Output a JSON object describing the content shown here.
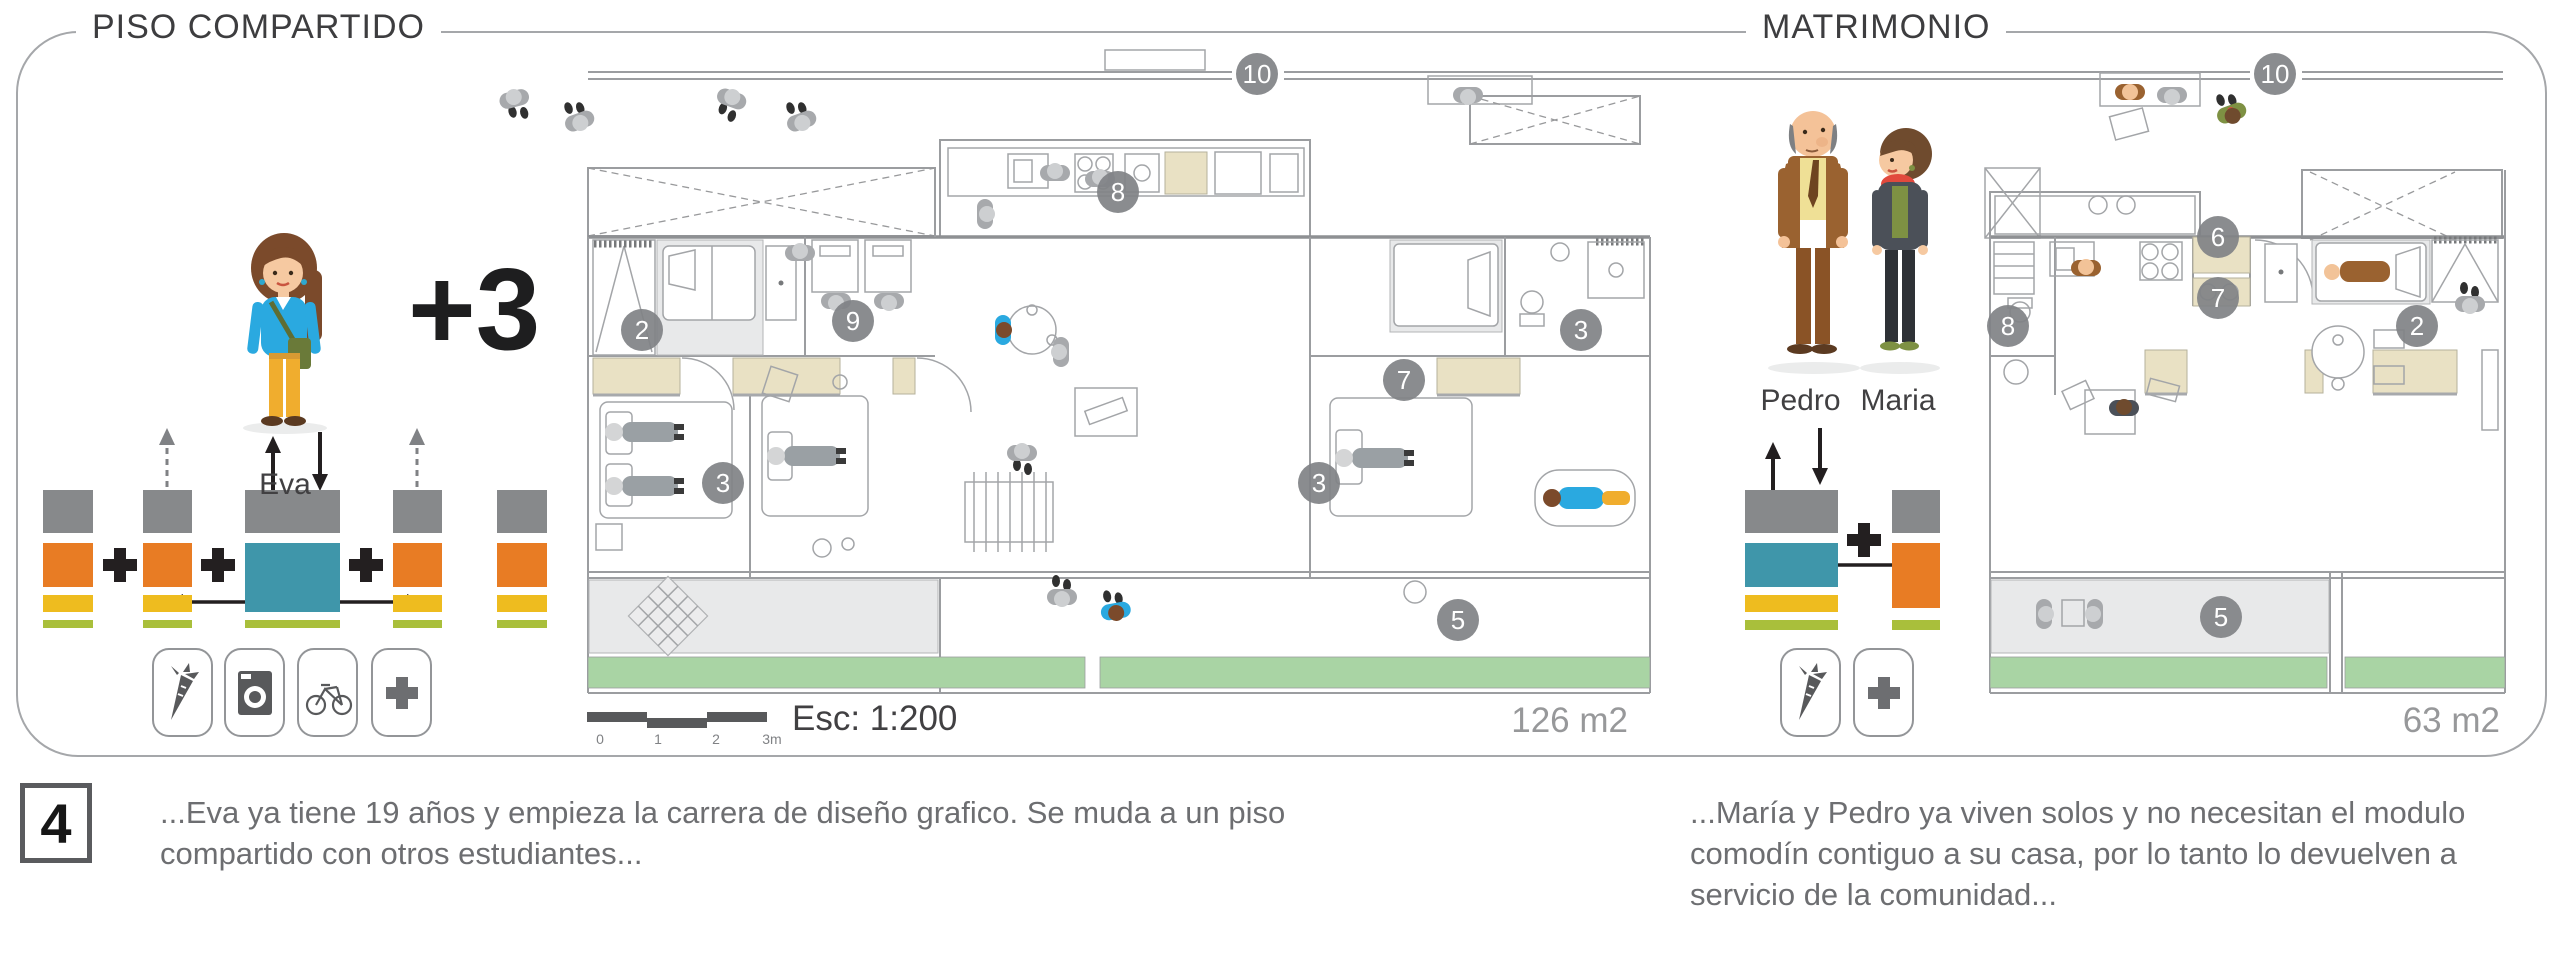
{
  "header": {
    "title_left": "PISO COMPARTIDO",
    "title_right": "MATRIMONIO"
  },
  "scenario_left": {
    "character_name": "Eva",
    "extra_occupants": "+3",
    "area_label": "126 m2",
    "icons": [
      "carrot-icon",
      "washing-machine-icon",
      "bicycle-icon",
      "plus-icon"
    ]
  },
  "scenario_right": {
    "character_names": [
      "Pedro",
      "Maria"
    ],
    "area_label": "63 m2",
    "icons": [
      "carrot-icon",
      "plus-icon"
    ]
  },
  "scale": {
    "label": "Esc: 1:200",
    "ticks": [
      {
        "t": "0",
        "x": 600
      },
      {
        "t": "1",
        "x": 658
      },
      {
        "t": "2",
        "x": 716
      },
      {
        "t": "3m",
        "x": 772
      }
    ]
  },
  "palette": {
    "gray": "#87898b",
    "orange": "#e87c24",
    "yellow": "#eebc1f",
    "teal": "#3f96aa",
    "olive": "#a9bf3b",
    "garden": "#a9d4a4",
    "beige": "#e9e1c4"
  },
  "module_blocks": [
    {
      "x": 43,
      "y": 490,
      "w": 50,
      "h": 43,
      "color": "#87898b"
    },
    {
      "x": 43,
      "y": 543,
      "w": 50,
      "h": 44,
      "color": "#e87c24"
    },
    {
      "x": 43,
      "y": 595,
      "w": 50,
      "h": 17,
      "color": "#eebc1f"
    },
    {
      "x": 43,
      "y": 620,
      "w": 50,
      "h": 8,
      "color": "#a9bf3b"
    },
    {
      "x": 143,
      "y": 490,
      "w": 49,
      "h": 43,
      "color": "#87898b"
    },
    {
      "x": 143,
      "y": 543,
      "w": 49,
      "h": 44,
      "color": "#e87c24"
    },
    {
      "x": 143,
      "y": 595,
      "w": 49,
      "h": 17,
      "color": "#eebc1f"
    },
    {
      "x": 143,
      "y": 620,
      "w": 49,
      "h": 8,
      "color": "#a9bf3b"
    },
    {
      "x": 245,
      "y": 490,
      "w": 95,
      "h": 43,
      "color": "#87898b"
    },
    {
      "x": 245,
      "y": 543,
      "w": 95,
      "h": 69,
      "color": "#3f96aa"
    },
    {
      "x": 245,
      "y": 620,
      "w": 95,
      "h": 8,
      "color": "#a9bf3b"
    },
    {
      "x": 393,
      "y": 490,
      "w": 49,
      "h": 43,
      "color": "#87898b"
    },
    {
      "x": 393,
      "y": 543,
      "w": 49,
      "h": 44,
      "color": "#e87c24"
    },
    {
      "x": 393,
      "y": 595,
      "w": 49,
      "h": 17,
      "color": "#eebc1f"
    },
    {
      "x": 393,
      "y": 620,
      "w": 49,
      "h": 8,
      "color": "#a9bf3b"
    },
    {
      "x": 497,
      "y": 490,
      "w": 50,
      "h": 43,
      "color": "#87898b"
    },
    {
      "x": 497,
      "y": 543,
      "w": 50,
      "h": 44,
      "color": "#e87c24"
    },
    {
      "x": 497,
      "y": 595,
      "w": 50,
      "h": 17,
      "color": "#eebc1f"
    },
    {
      "x": 497,
      "y": 620,
      "w": 50,
      "h": 8,
      "color": "#a9bf3b"
    },
    {
      "x": 1745,
      "y": 490,
      "w": 93,
      "h": 43,
      "color": "#87898b"
    },
    {
      "x": 1745,
      "y": 543,
      "w": 93,
      "h": 44,
      "color": "#3f96aa"
    },
    {
      "x": 1745,
      "y": 595,
      "w": 93,
      "h": 17,
      "color": "#eebc1f"
    },
    {
      "x": 1745,
      "y": 620,
      "w": 93,
      "h": 10,
      "color": "#a9bf3b"
    },
    {
      "x": 1892,
      "y": 490,
      "w": 48,
      "h": 43,
      "color": "#87898b"
    },
    {
      "x": 1892,
      "y": 543,
      "w": 48,
      "h": 65,
      "color": "#e87c24"
    },
    {
      "x": 1892,
      "y": 620,
      "w": 48,
      "h": 10,
      "color": "#a9bf3b"
    }
  ],
  "plan_markers": [
    {
      "label": "10",
      "x": 1257,
      "y": 74
    },
    {
      "label": "8",
      "x": 1118,
      "y": 192
    },
    {
      "label": "2",
      "x": 642,
      "y": 330
    },
    {
      "label": "9",
      "x": 853,
      "y": 321
    },
    {
      "label": "3",
      "x": 723,
      "y": 483
    },
    {
      "label": "3",
      "x": 1319,
      "y": 483
    },
    {
      "label": "3",
      "x": 1581,
      "y": 330
    },
    {
      "label": "7",
      "x": 1404,
      "y": 380
    },
    {
      "label": "5",
      "x": 1458,
      "y": 620
    },
    {
      "label": "10",
      "x": 2275,
      "y": 74
    },
    {
      "label": "6",
      "x": 2218,
      "y": 237
    },
    {
      "label": "7",
      "x": 2218,
      "y": 298
    },
    {
      "label": "2",
      "x": 2417,
      "y": 326
    },
    {
      "label": "8",
      "x": 2008,
      "y": 326
    },
    {
      "label": "5",
      "x": 2221,
      "y": 617
    }
  ],
  "footer": {
    "step_number": "4",
    "caption_left": "...Eva ya tiene 19 años y empieza la carrera de diseño grafico. Se muda a un piso compartido con otros estudiantes...",
    "caption_right": "...María y Pedro ya viven solos y no necesitan el modulo comodín contiguo a su casa, por lo tanto lo devuelven a servicio de la comunidad..."
  }
}
